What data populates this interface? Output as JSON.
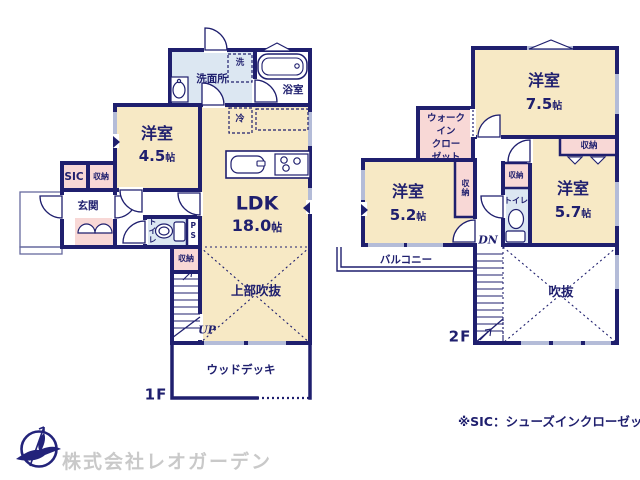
{
  "colors": {
    "wall_navy": "#1f1f6e",
    "room_cream": "#f7e9c5",
    "closet_pink": "#f8d8d6",
    "wet_area_blue": "#dce7f2",
    "window_gray": "#b4bcd8",
    "company_gray": "#c9c9c9"
  },
  "floor1": {
    "label": "1F",
    "washroom": "洗面所",
    "washer": "洗",
    "bathroom": "浴室",
    "fridge": "冷",
    "bedroom": {
      "name": "洋室",
      "size": "4.5",
      "unit": "帖"
    },
    "sic": "SIC",
    "closet_entrance": "収納",
    "entrance": "玄関",
    "ldk": {
      "name": "LDK",
      "size": "18.0",
      "unit": "帖"
    },
    "toilet": "トイレ",
    "ps": "PS",
    "closet_stairs": "収納",
    "void_upper": "上部吹抜",
    "stairs_up": "UP",
    "wood_deck": "ウッドデッキ"
  },
  "floor2": {
    "label": "2F",
    "bedroom_75": {
      "name": "洋室",
      "size": "7.5",
      "unit": "帖"
    },
    "wic": {
      "lines": [
        "ウォーク",
        "イン",
        "クロー",
        "ゼット"
      ]
    },
    "bedroom_52": {
      "name": "洋室",
      "size": "5.2",
      "unit": "帖"
    },
    "closet_52": "収納",
    "closet_center": "収納",
    "toilet": "トイレ",
    "bedroom_57": {
      "name": "洋室",
      "size": "5.7",
      "unit": "帖"
    },
    "closet_57": "収納",
    "balcony": "バルコニー",
    "stairs_down": "DN",
    "void": "吹抜"
  },
  "footnote": "※SIC：シューズインクローゼット",
  "company": "株式会社レオガーデン"
}
